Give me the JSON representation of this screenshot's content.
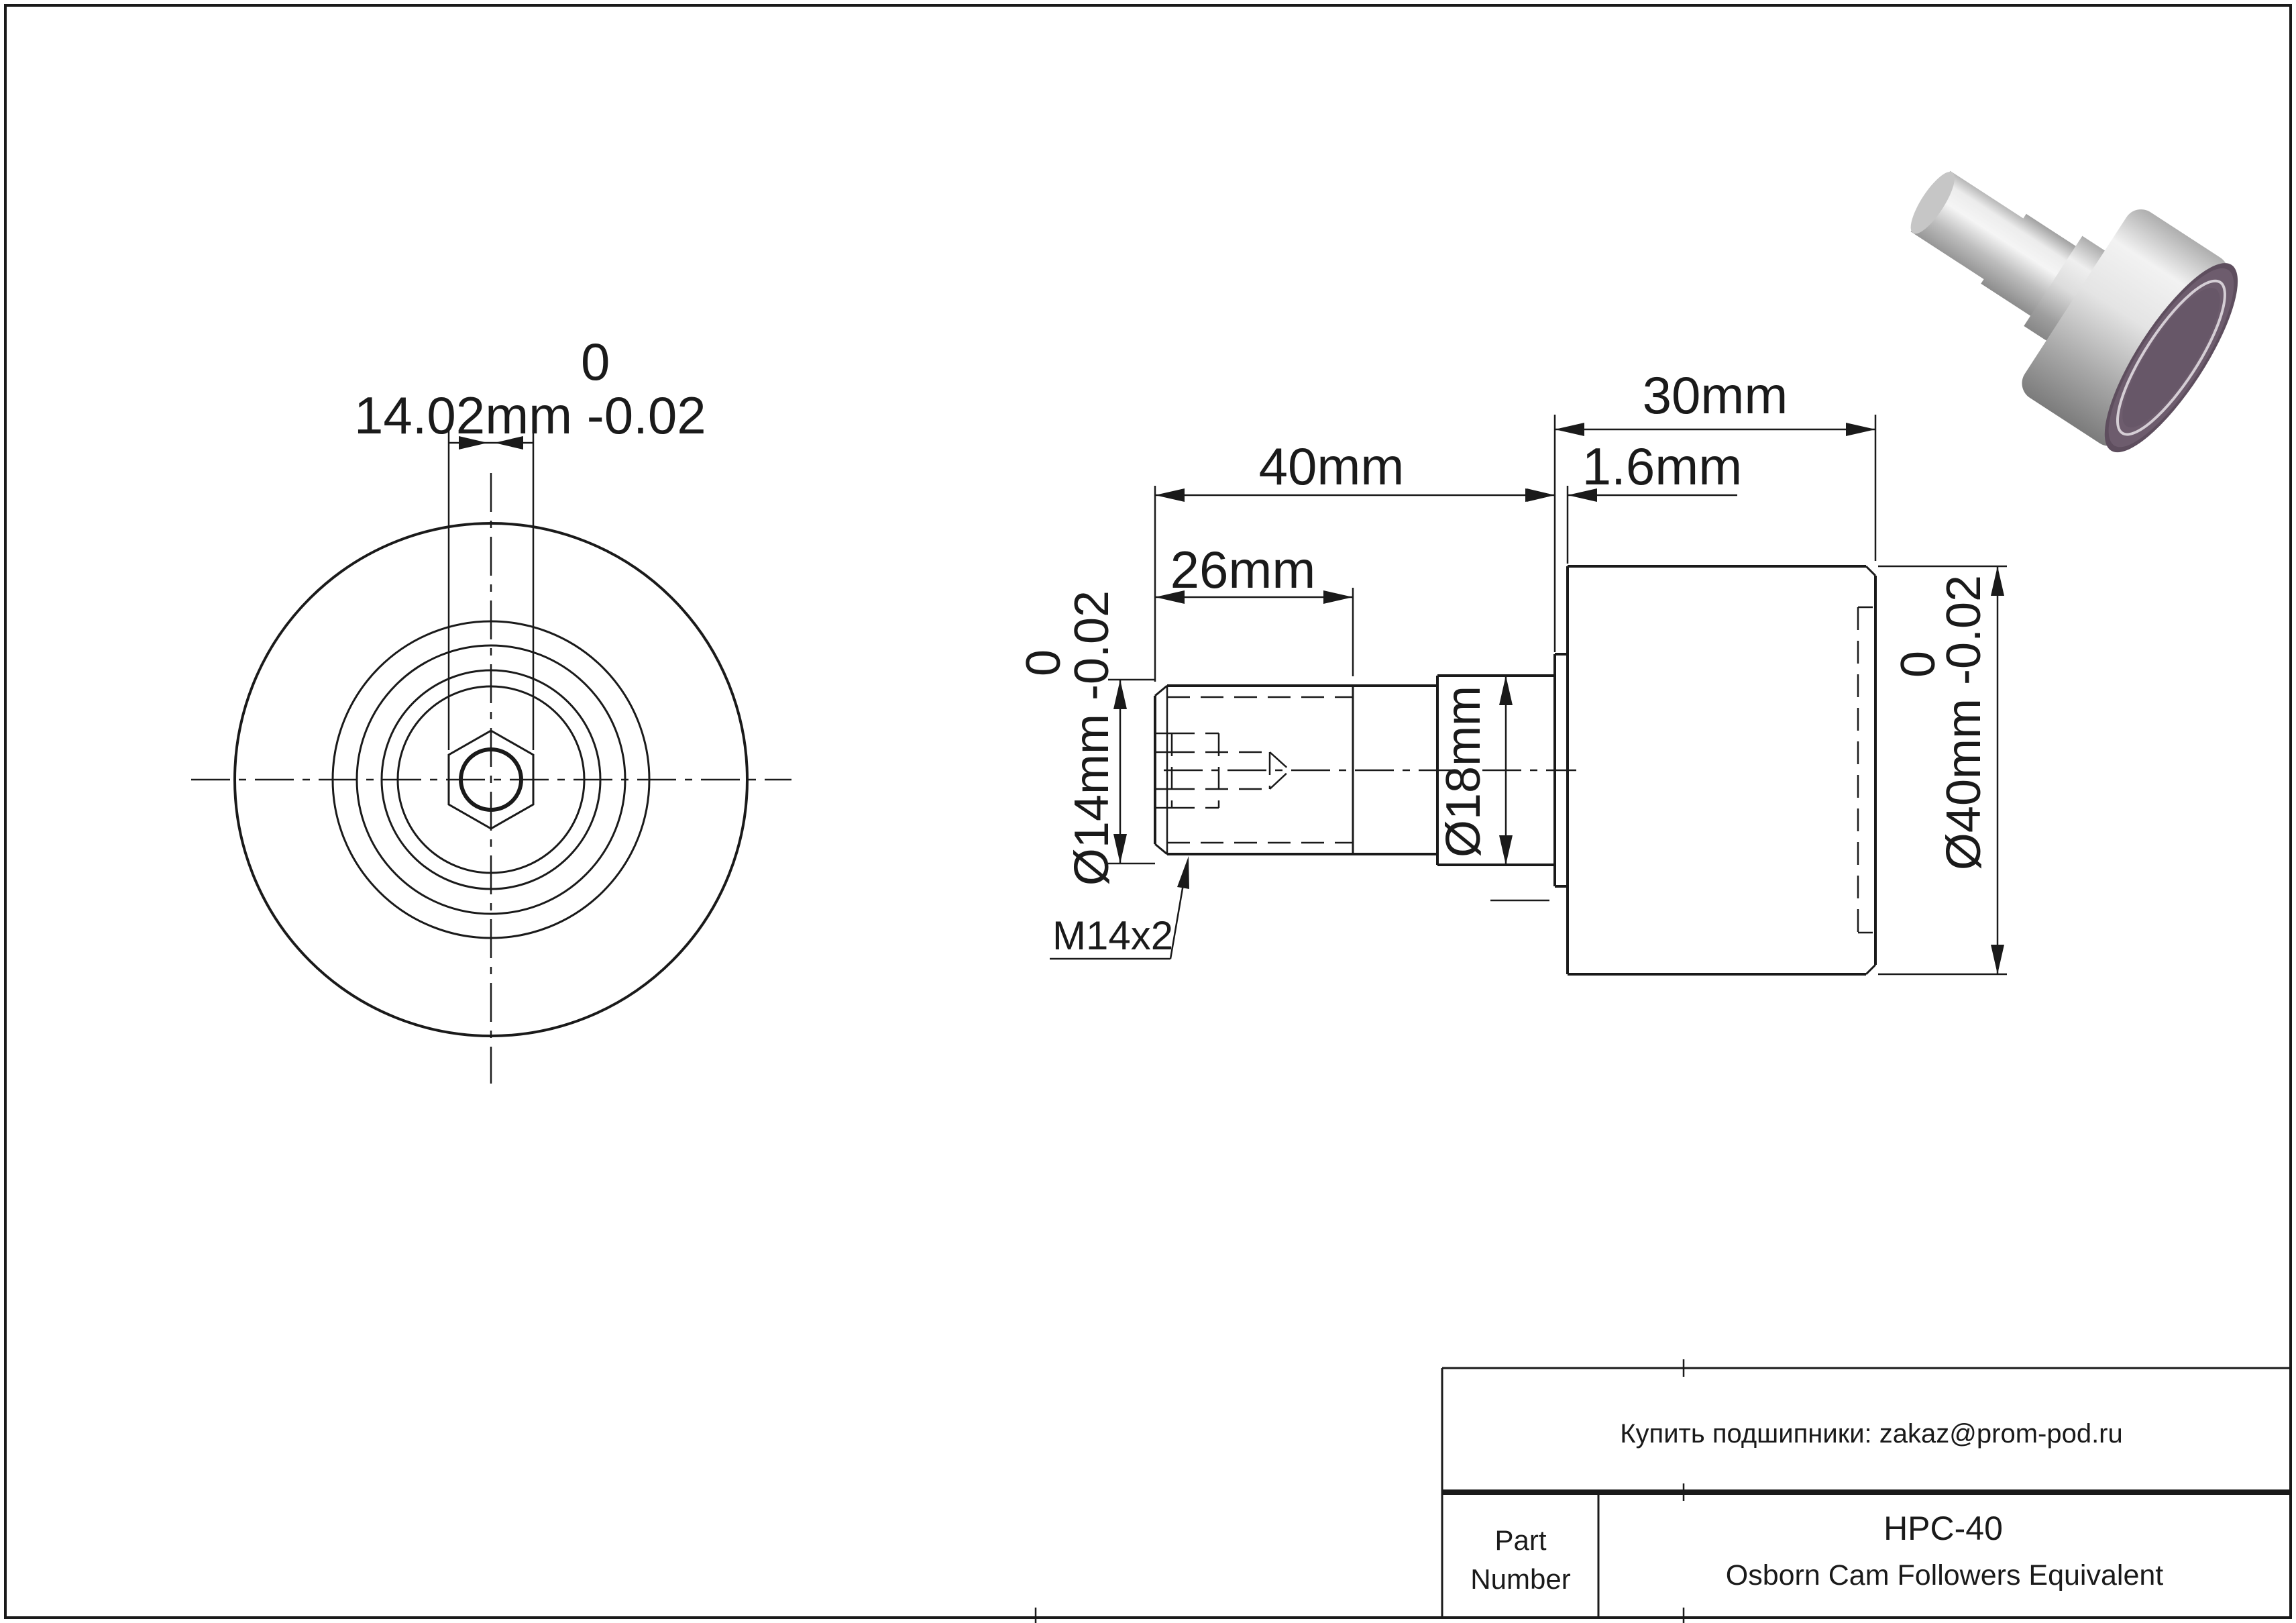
{
  "front_view": {
    "dim_width": {
      "label": "14.02mm -0.02",
      "tol_upper": "0"
    }
  },
  "side_view": {
    "dim_overall_roller": "30mm",
    "dim_stud_to_flange": "40mm",
    "dim_flange_width": "1.6mm",
    "dim_thread_length": "26mm",
    "dim_stud_dia": {
      "label": "Ø14mm -0.02",
      "tol_upper": "0"
    },
    "dim_collar_dia": "Ø18mm",
    "dim_roller_dia": {
      "label": "Ø40mm -0.02",
      "tol_upper": "0"
    },
    "thread_spec": "M14x2"
  },
  "title_block": {
    "contact": "Купить подшипники: zakaz@prom-pod.ru",
    "part_label_line1": "Part",
    "part_label_line2": "Number",
    "part_number": "HPC-40",
    "description": "Osborn Cam Followers Equivalent"
  },
  "render": {
    "face_color": "#6d5c6d",
    "face_rim_color": "#5e4e5e",
    "metal_light": "#f5f5f5",
    "metal_dark": "#7a7a7a"
  }
}
